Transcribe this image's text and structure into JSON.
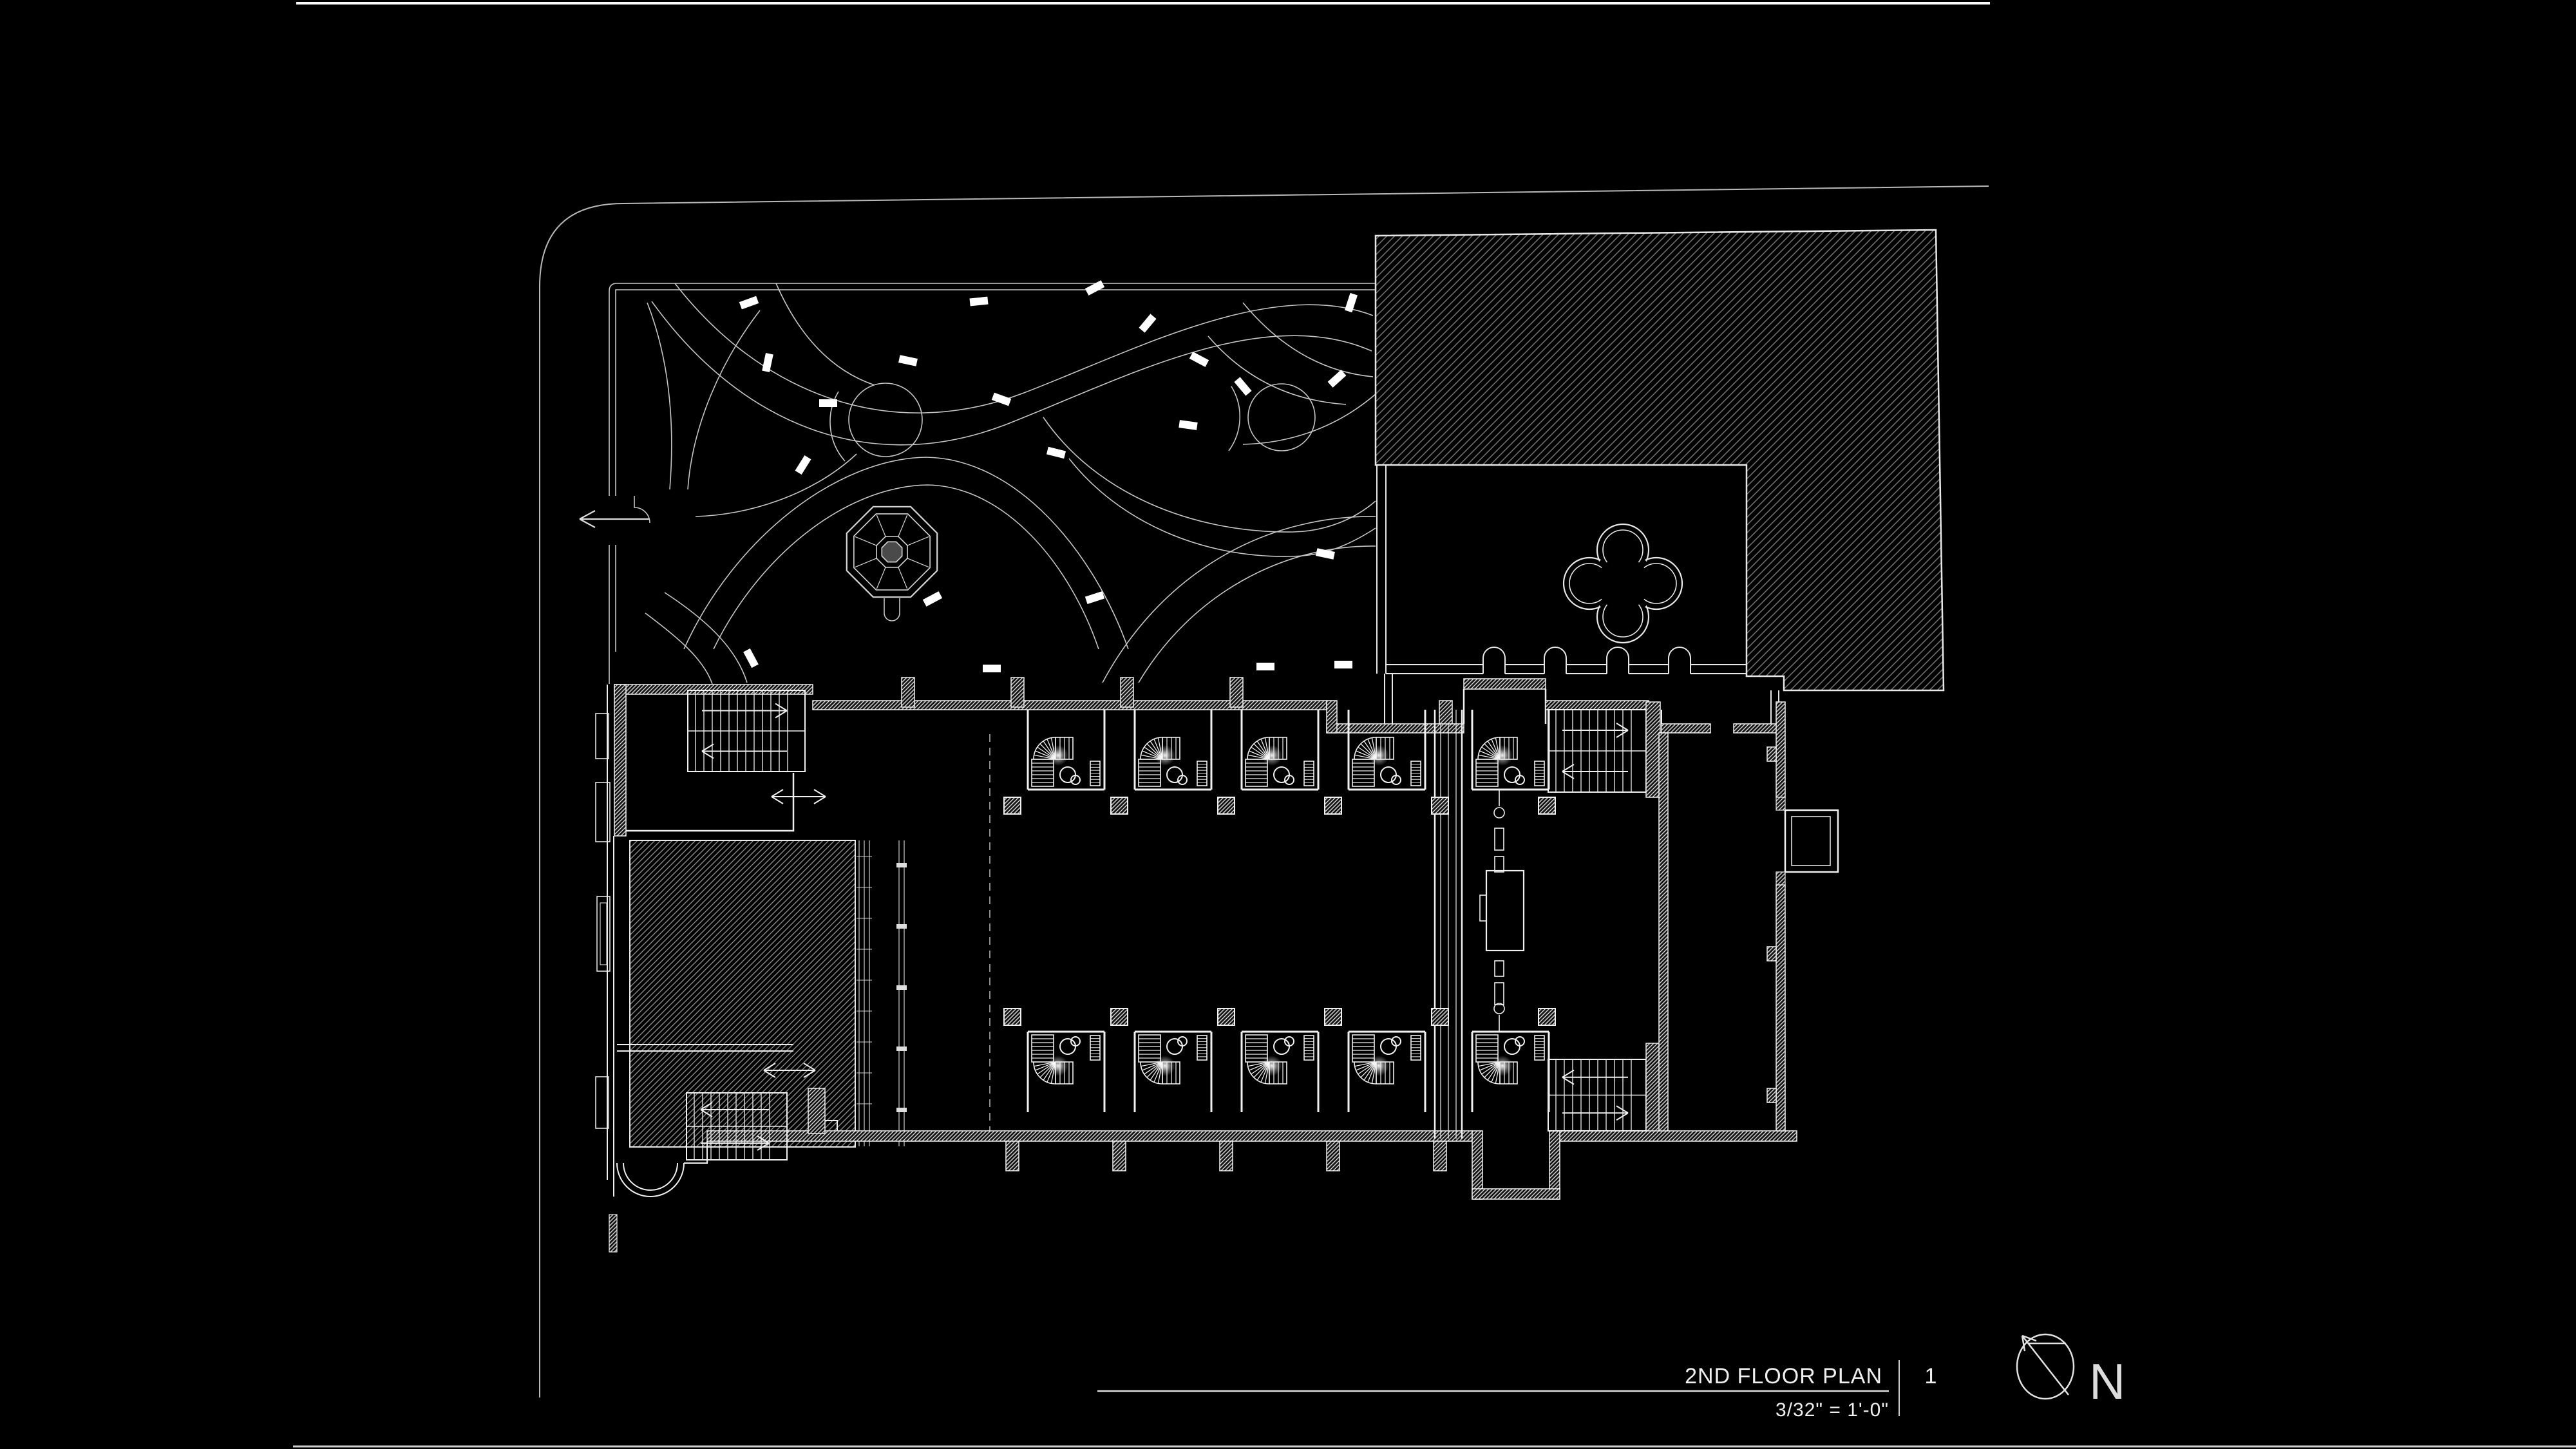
{
  "title_block": {
    "title": "2ND FLOOR PLAN",
    "scale": "3/32\" = 1'-0\"",
    "sheet_number": "1"
  },
  "north_arrow": {
    "label": "N"
  },
  "colors": {
    "background": "#000000",
    "line": "#ebebeb",
    "site_line": "#b8b8b8",
    "garden_line": "#c6c6c6",
    "hatch": "#6e6e6e",
    "bench": "#ffffff"
  }
}
